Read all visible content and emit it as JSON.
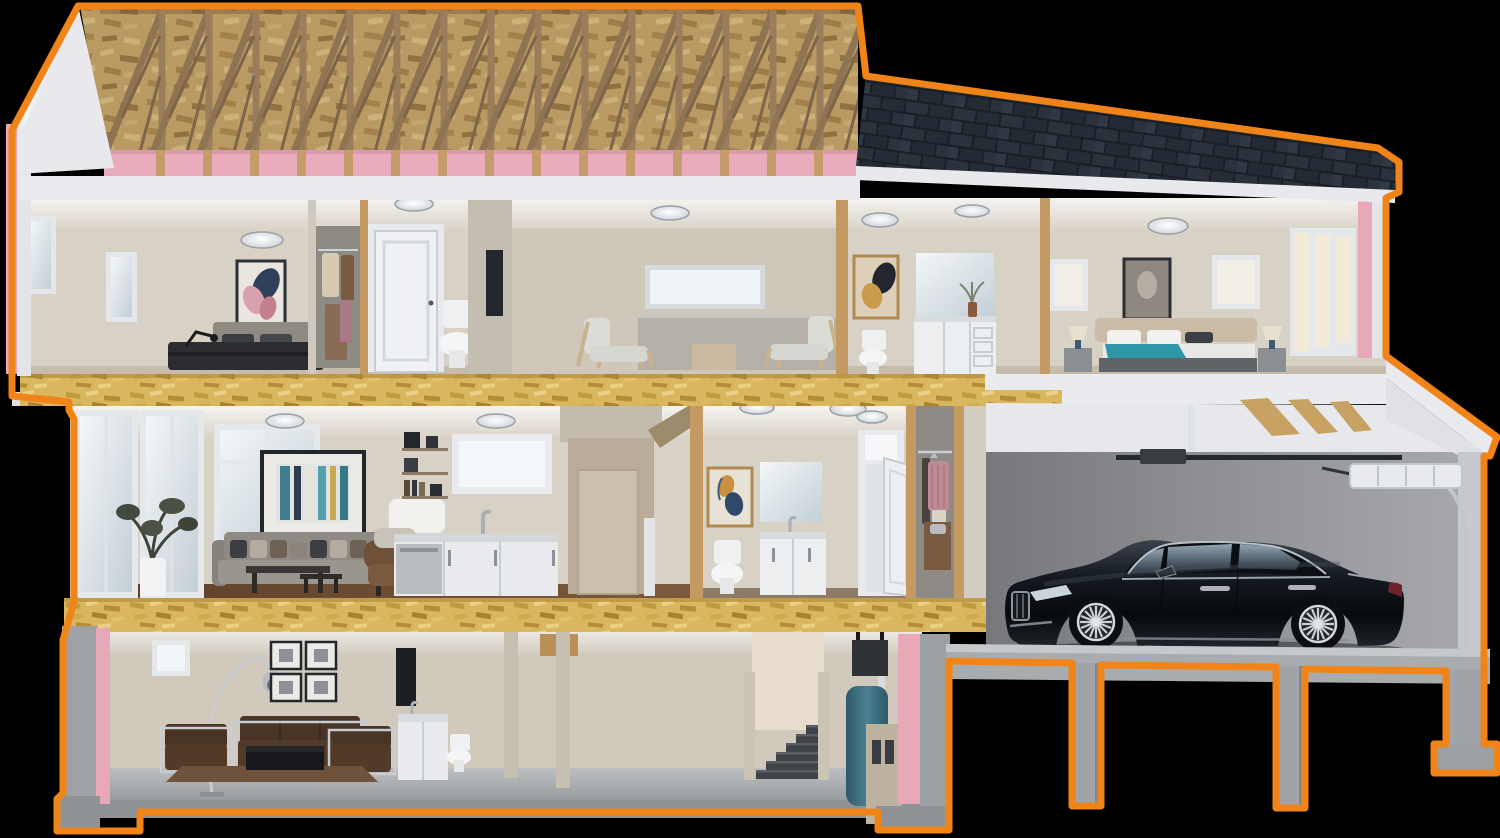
{
  "scene": {
    "title": "3D cutaway cross-section of a two-storey house with basement and attached garage, outlined in orange on a black background",
    "type": "architectural-cutaway-render",
    "text_visible": "none"
  },
  "palette": {
    "outline": "#F08418",
    "background": "#000000",
    "insulation_pink": "#E8A8B8",
    "osb_floor": "#D9B75F",
    "osb_attic": "#B99A62",
    "truss_wood": "#8F7454",
    "shingle_dark": "#20262E",
    "fascia_white": "#E7E9ED",
    "interior_beige": "#D8D1C5",
    "stud_wood": "#C49A62",
    "concrete": "#9EA2A6",
    "garage_wall": "#8A8C8F",
    "car_black": "#0C0F13"
  },
  "structure": {
    "trusses": {
      "count": 16,
      "start_x": 106,
      "spacing": 47,
      "bottom_y": 152,
      "top_y": 10,
      "run": 56
    },
    "garage_piers": 3,
    "floors": [
      "attic",
      "second-floor",
      "main-floor",
      "basement"
    ],
    "insulation_bands": [
      "attic floor",
      "left wall",
      "right wall",
      "basement walls"
    ]
  },
  "levels": {
    "attic": {
      "features": [
        "wood roof trusses",
        "OSB sheathing",
        "pink insulation batts",
        "asphalt shingle roof on right",
        "white gable end on left"
      ]
    },
    "second_floor": {
      "rooms": [
        {
          "name": "bedroom-left",
          "items": [
            "two windows",
            "floral wall art",
            "bed with dark duvet",
            "black desk lamp",
            "ceiling light"
          ]
        },
        {
          "name": "closet",
          "items": [
            "hanging clothes"
          ]
        },
        {
          "name": "hallway",
          "items": [
            "white panel door",
            "ceiling light"
          ]
        },
        {
          "name": "bathroom-small",
          "items": [
            "toilet"
          ]
        },
        {
          "name": "sitting-loft",
          "items": [
            "frosted transom window",
            "two wood-frame armchairs",
            "side table",
            "stair half-wall",
            "ceiling light"
          ]
        },
        {
          "name": "bathroom-main",
          "items": [
            "abstract wall art",
            "toilet",
            "white vanity with mirror",
            "flower vase",
            "ceiling lights"
          ]
        },
        {
          "name": "bedroom-right",
          "items": [
            "horse wall art",
            "bed with teal throw",
            "two bedside lamps",
            "two small windows",
            "triple window",
            "ceiling light"
          ]
        }
      ]
    },
    "main_floor": {
      "rooms": [
        {
          "name": "living-room",
          "items": [
            "glass patio doors",
            "tall window",
            "potted plant",
            "grey sofa with pillows",
            "teal abstract painting",
            "coffee tables",
            "floor lamp",
            "brown armchair",
            "dark wood floor"
          ]
        },
        {
          "name": "kitchen",
          "items": [
            "wall shelves with coffee maker and books",
            "window",
            "sink and faucet",
            "white cabinets",
            "stainless dishwasher"
          ]
        },
        {
          "name": "stairwell",
          "items": [
            "stair opening",
            "white newel post",
            "wood post"
          ]
        },
        {
          "name": "bathroom",
          "items": [
            "abstract wall art",
            "mirror",
            "toilet",
            "white vanity"
          ]
        },
        {
          "name": "entry",
          "items": [
            "open white front door with transom",
            "two ceiling lights"
          ]
        },
        {
          "name": "entry-closet",
          "items": [
            "hanging sweater and skirt",
            "closet rod"
          ]
        }
      ]
    },
    "basement": {
      "rooms": [
        {
          "name": "family-room",
          "items": [
            "small window",
            "chrome arc lamp",
            "four framed pictures",
            "brown leather sofa and two armchairs with chrome frames",
            "black coffee table",
            "brown rug"
          ]
        },
        {
          "name": "bath-laundry",
          "items": [
            "dark wall panel",
            "white cabinet with sink",
            "toilet"
          ]
        },
        {
          "name": "stairs",
          "items": [
            "carpeted steps",
            "railing walls"
          ]
        },
        {
          "name": "utility",
          "items": [
            "black duct box",
            "teal water heater",
            "beige furnace",
            "white flue pipe"
          ]
        }
      ]
    },
    "garage": {
      "items": [
        "black luxury sedan facing left",
        "garage door opener rail",
        "rolled-up sectional door",
        "curved door track",
        "white ceiling with wood joists",
        "concrete slab on three piers with footing"
      ]
    }
  }
}
